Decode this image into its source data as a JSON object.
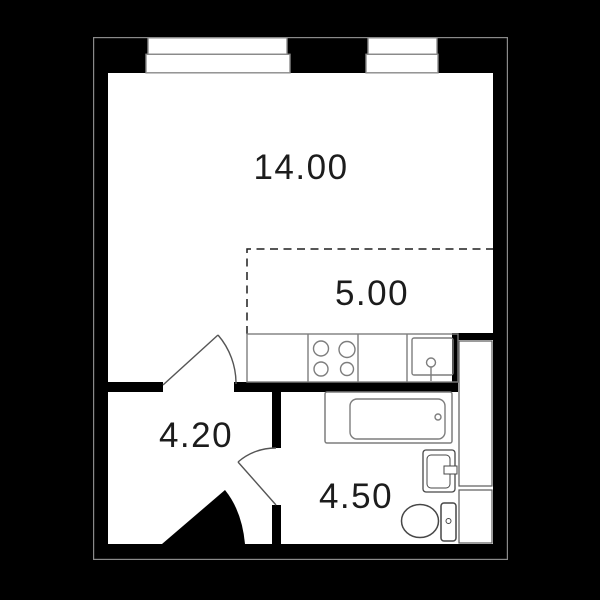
{
  "plan": {
    "type": "apartment-floor-plan",
    "background_color": "#000000",
    "wall_color": "#000000",
    "floor_color": "#ffffff",
    "outline_color": "#8a8a8a",
    "label_color": "#1c1c1c",
    "rooms": [
      {
        "id": "living-room",
        "area": "14.00"
      },
      {
        "id": "kitchen-zone",
        "area": "5.00",
        "boundary": "dashed"
      },
      {
        "id": "hallway",
        "area": "4.20"
      },
      {
        "id": "bathroom",
        "area": "4.50"
      }
    ],
    "windows": 2,
    "doors": 2,
    "fixtures": [
      "kitchen-counter",
      "stove-four-burners",
      "kitchen-sink-with-tap",
      "bathtub",
      "washbasin",
      "toilet",
      "service-shaft-upper",
      "service-shaft-lower"
    ]
  }
}
